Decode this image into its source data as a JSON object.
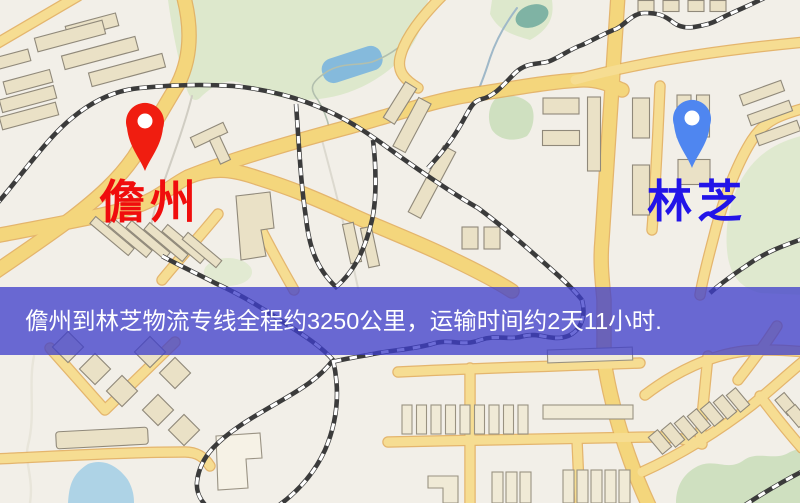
{
  "map": {
    "origin_marker": {
      "label": "儋州",
      "pin_color": "#f01d10",
      "label_color": "#f00d0d",
      "pin_icon": "location-pin"
    },
    "destination_marker": {
      "label": "林芝",
      "pin_color": "#4f86f0",
      "label_color": "#2214e8",
      "pin_icon": "location-pin"
    },
    "banner": {
      "text": "儋州到林芝物流专线全程约3250公里，运输时间约2天11小时.",
      "bg_color": "rgba(62,62,202,0.76)",
      "text_color": "#ffffff",
      "distance_text": "约3250公里",
      "duration_text": "约2天11小时"
    },
    "palette": {
      "land": "#f2efe8",
      "road": "#f4d67c",
      "water": "#85badc",
      "park": "#dde8cc"
    }
  }
}
